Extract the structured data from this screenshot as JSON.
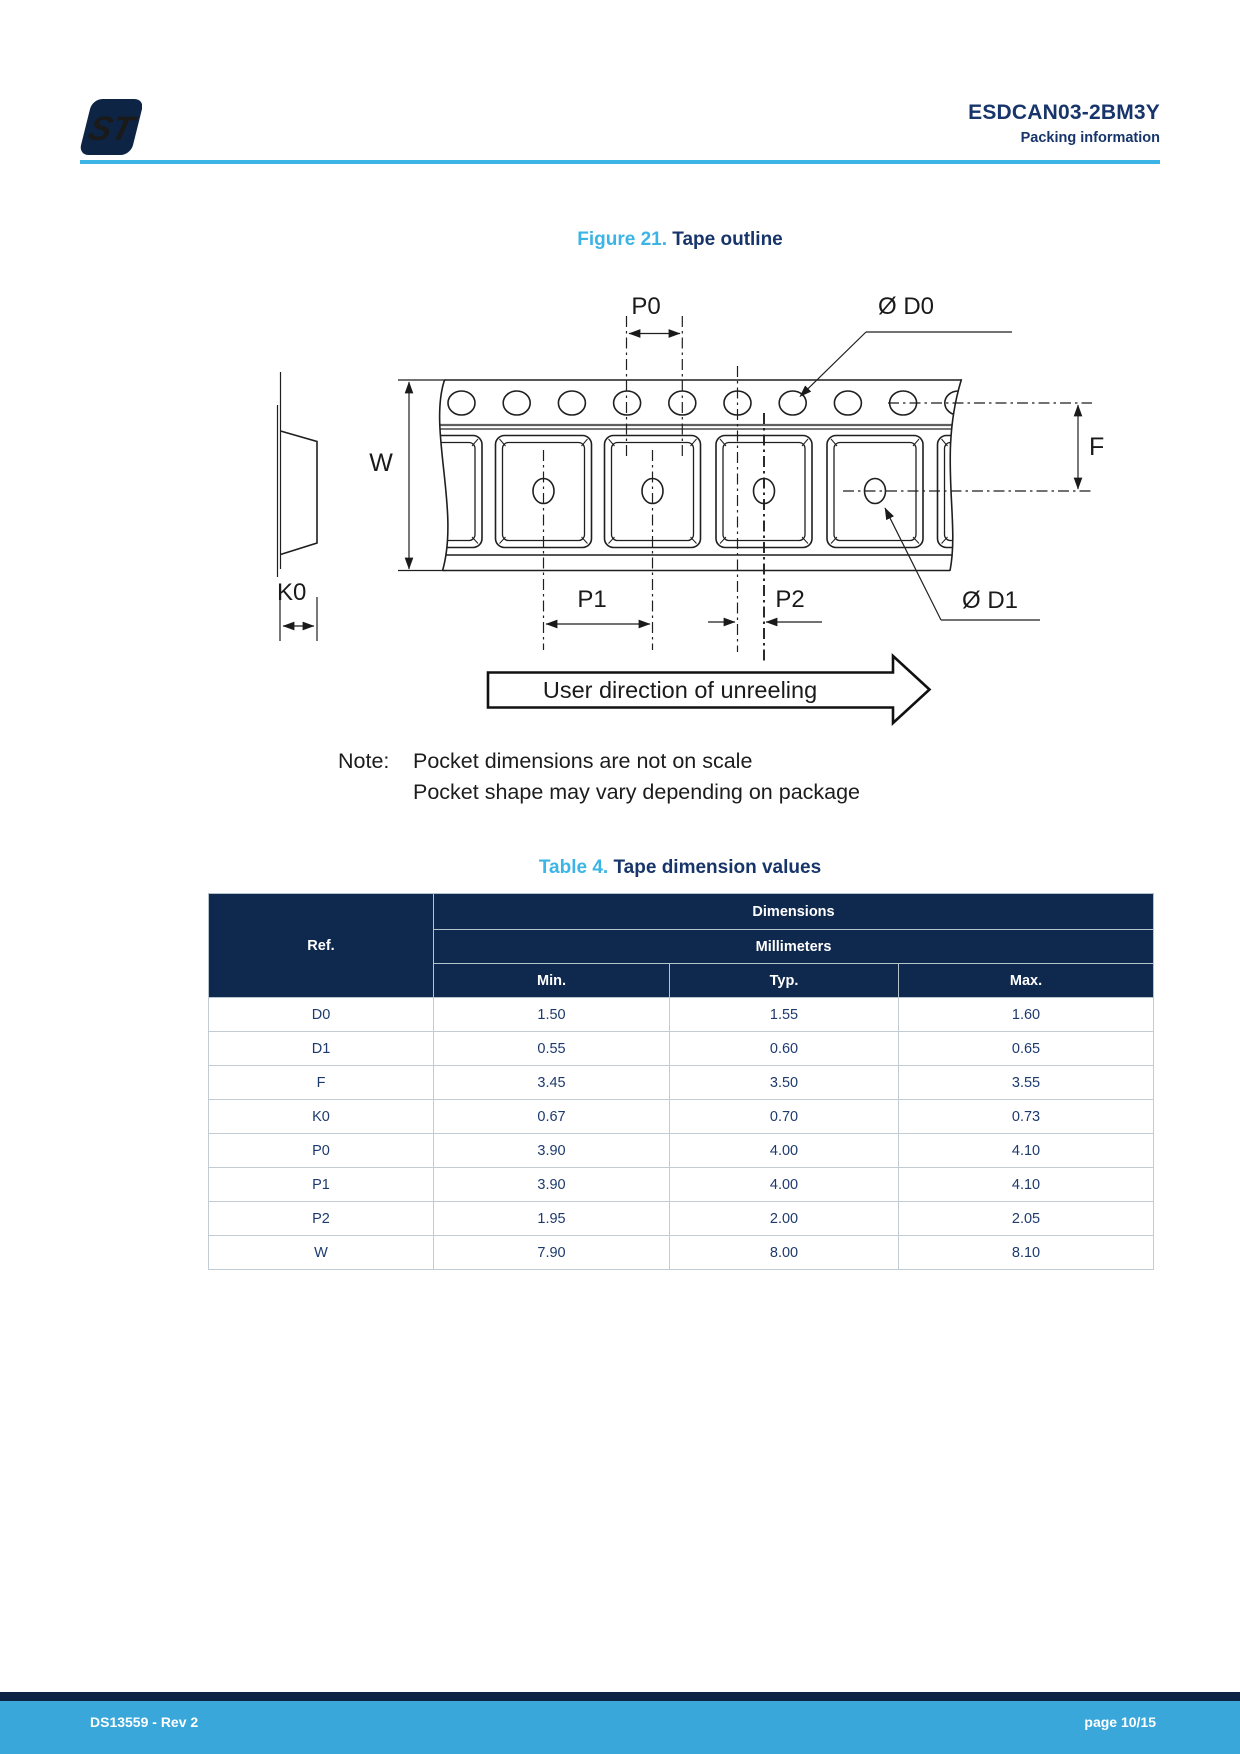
{
  "colors": {
    "accent_blue": "#3cb4e6",
    "heading_navy": "#17356a",
    "table_header_bg": "#0f294e",
    "cell_text_navy": "#1d3a6d",
    "footer_bar_blue": "#39a7d9",
    "footer_strip_navy": "#0d2444"
  },
  "header": {
    "product": "ESDCAN03-2BM3Y",
    "section": "Packing information",
    "logo_text": "ST"
  },
  "figure": {
    "label": "Figure 21.",
    "title": "Tape outline",
    "labels": {
      "p0": "P0",
      "d0": "Ø D0",
      "w": "W",
      "f": "F",
      "k0": "K0",
      "p1": "P1",
      "p2": "P2",
      "d1": "Ø D1"
    },
    "direction_text": "User direction of unreeling",
    "note_label": "Note:",
    "note_line1": "Pocket dimensions are not on scale",
    "note_line2": "Pocket shape may vary depending on package"
  },
  "table": {
    "label": "Table 4.",
    "title": "Tape dimension values",
    "headers": {
      "ref": "Ref.",
      "dimensions": "Dimensions",
      "unit": "Millimeters",
      "min": "Min.",
      "typ": "Typ.",
      "max": "Max."
    },
    "rows": [
      {
        "ref": "D0",
        "min": "1.50",
        "typ": "1.55",
        "max": "1.60"
      },
      {
        "ref": "D1",
        "min": "0.55",
        "typ": "0.60",
        "max": "0.65"
      },
      {
        "ref": "F",
        "min": "3.45",
        "typ": "3.50",
        "max": "3.55"
      },
      {
        "ref": "K0",
        "min": "0.67",
        "typ": "0.70",
        "max": "0.73"
      },
      {
        "ref": "P0",
        "min": "3.90",
        "typ": "4.00",
        "max": "4.10"
      },
      {
        "ref": "P1",
        "min": "3.90",
        "typ": "4.00",
        "max": "4.10"
      },
      {
        "ref": "P2",
        "min": "1.95",
        "typ": "2.00",
        "max": "2.05"
      },
      {
        "ref": "W",
        "min": "7.90",
        "typ": "8.00",
        "max": "8.10"
      }
    ]
  },
  "footer": {
    "doc_ref": "DS13559 - Rev 2",
    "page_num": "page 10/15"
  }
}
